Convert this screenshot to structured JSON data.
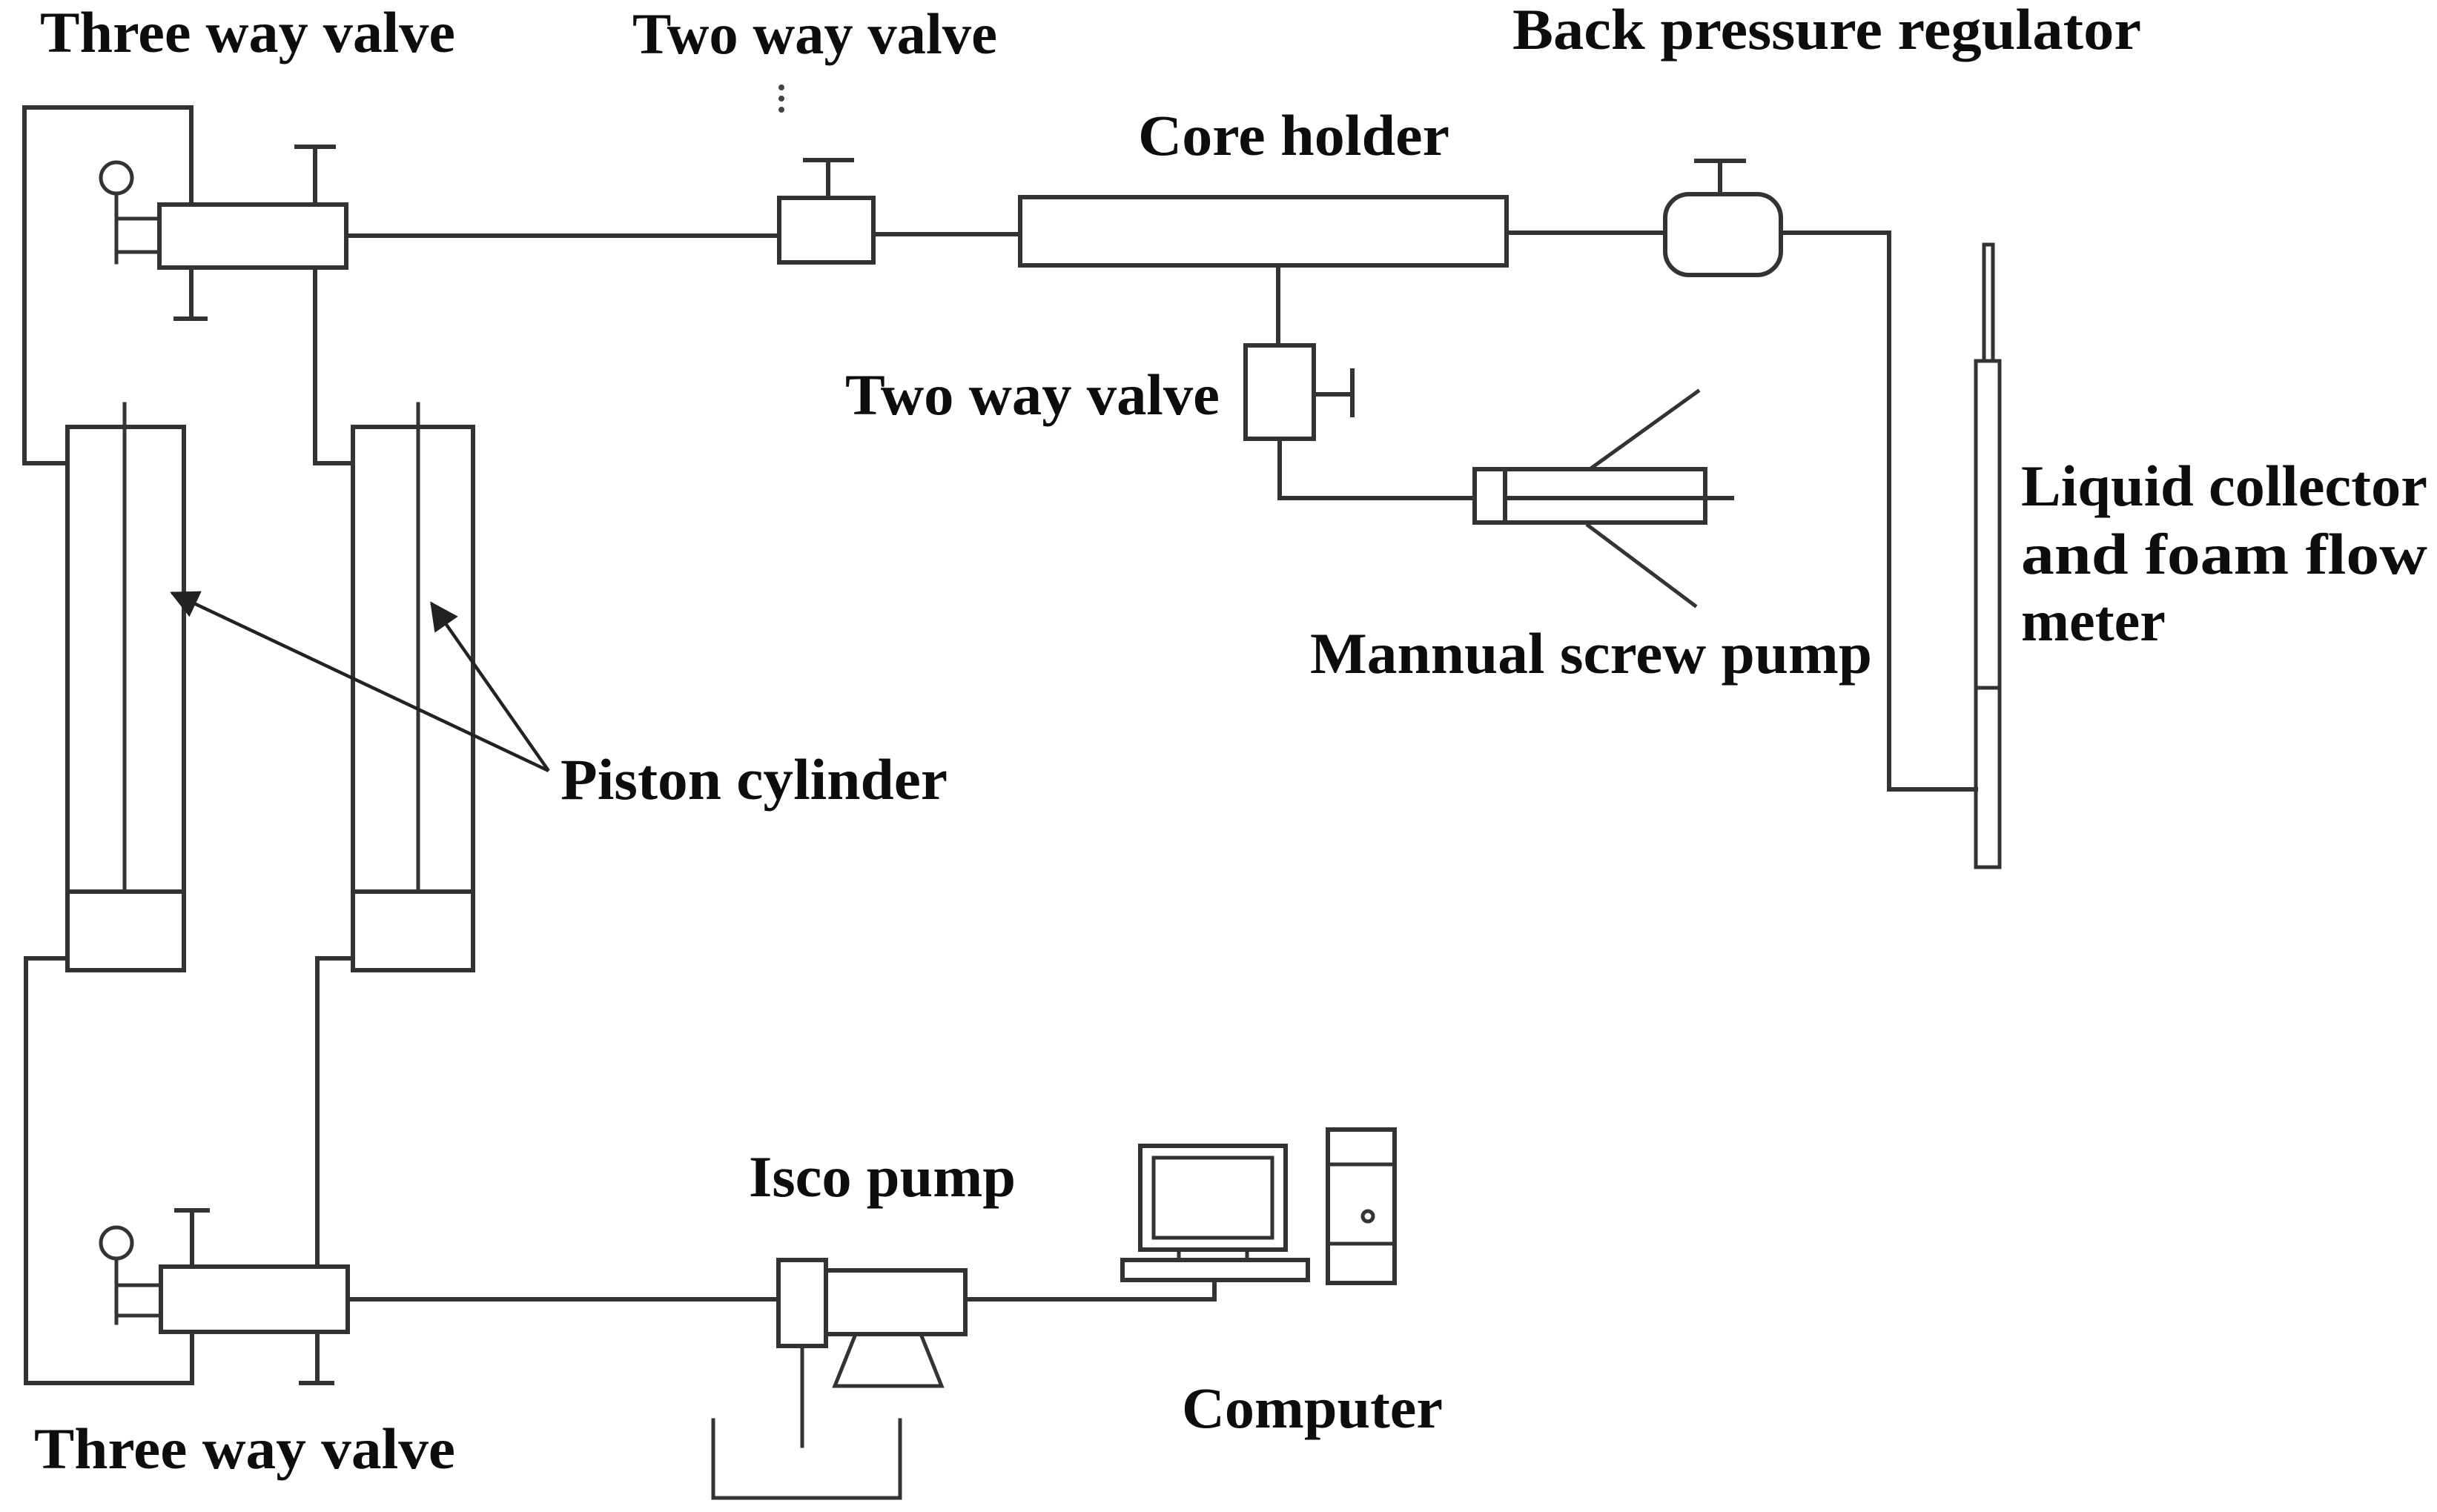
{
  "diagram": {
    "labels": {
      "three_way_valve_top": "Three way valve",
      "two_way_valve_top": "Two way valve",
      "core_holder": "Core holder",
      "back_pressure_regulator": "Back pressure regulator",
      "two_way_valve_mid": "Two way valve",
      "manual_screw_pump": "Mannual screw pump",
      "piston_cylinder": "Piston cylinder",
      "liquid_collector_line1": "Liquid collector",
      "liquid_collector_line2": "and foam flow",
      "liquid_collector_line3": "meter",
      "isco_pump": "Isco pump",
      "computer": "Computer",
      "three_way_valve_bottom": "Three way valve"
    },
    "colors": {
      "line": "#333333",
      "text": "#0d0d0d",
      "background": "#ffffff"
    }
  }
}
